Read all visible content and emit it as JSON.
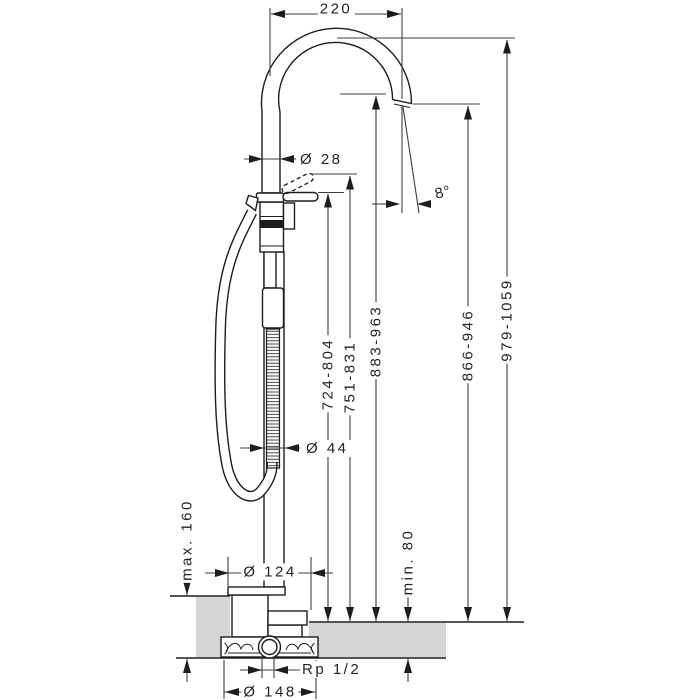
{
  "dims": {
    "reach": "220",
    "spout_pipe_diameter": "Ø 28",
    "spout_angle": "8°",
    "height_handle": "724-804",
    "height_handle_raised": "751-831",
    "height_spout_top_edge": "883-963",
    "height_spout_outlet": "866-946",
    "height_overall": "979-1059",
    "riser_diameter": "Ø 44",
    "floor_buildup_max": "max. 160",
    "floor_buildup_min": "min. 80",
    "escutcheon_diameter": "Ø 124",
    "basic_set_diameter": "Ø 148",
    "connection_thread": "Rp 1/2"
  },
  "colors": {
    "line": "#1d1d1b",
    "dimension_line": "#3f3f3f",
    "floor_fill": "#d5d5d5"
  }
}
